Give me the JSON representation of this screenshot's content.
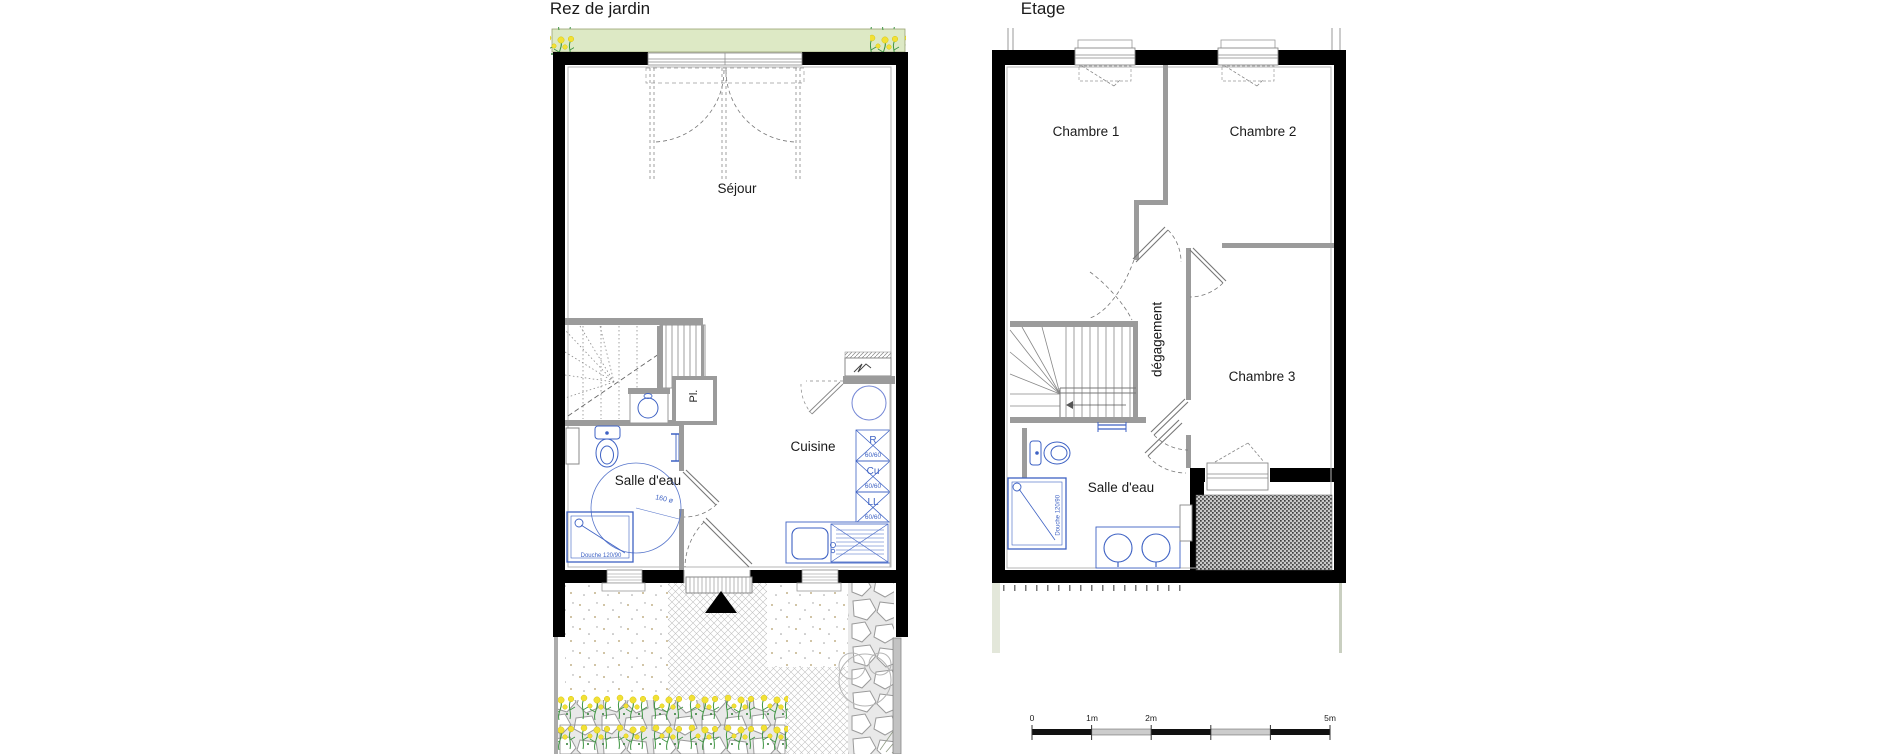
{
  "rdj": {
    "title": "Rez de jardin",
    "rooms": {
      "sejour": "Séjour",
      "cuisine": "Cuisine",
      "salle_eau": "Salle d'eau",
      "placard": "Pl."
    },
    "notes": {
      "turning_circle": "160 ø",
      "shower": "Douche 120/90"
    },
    "appliances": [
      {
        "label": "R",
        "size": "60/60"
      },
      {
        "label": "Cu",
        "size": "60/60"
      },
      {
        "label": "LL",
        "size": "60/60"
      }
    ]
  },
  "etage": {
    "title": "Etage",
    "rooms": {
      "chambre1": "Chambre 1",
      "chambre2": "Chambre 2",
      "chambre3": "Chambre 3",
      "degagement": "dégagement",
      "salle_eau": "Salle d'eau"
    },
    "notes": {
      "shower": "Douche 120/90"
    }
  },
  "scale_bar": {
    "labels": [
      "0",
      "1m",
      "2m",
      "5m"
    ]
  },
  "colors": {
    "wall": "#000000",
    "partition": "#9b9b9b",
    "plumbing": "#3e62c4",
    "garden_strip": "#dde9c5"
  }
}
